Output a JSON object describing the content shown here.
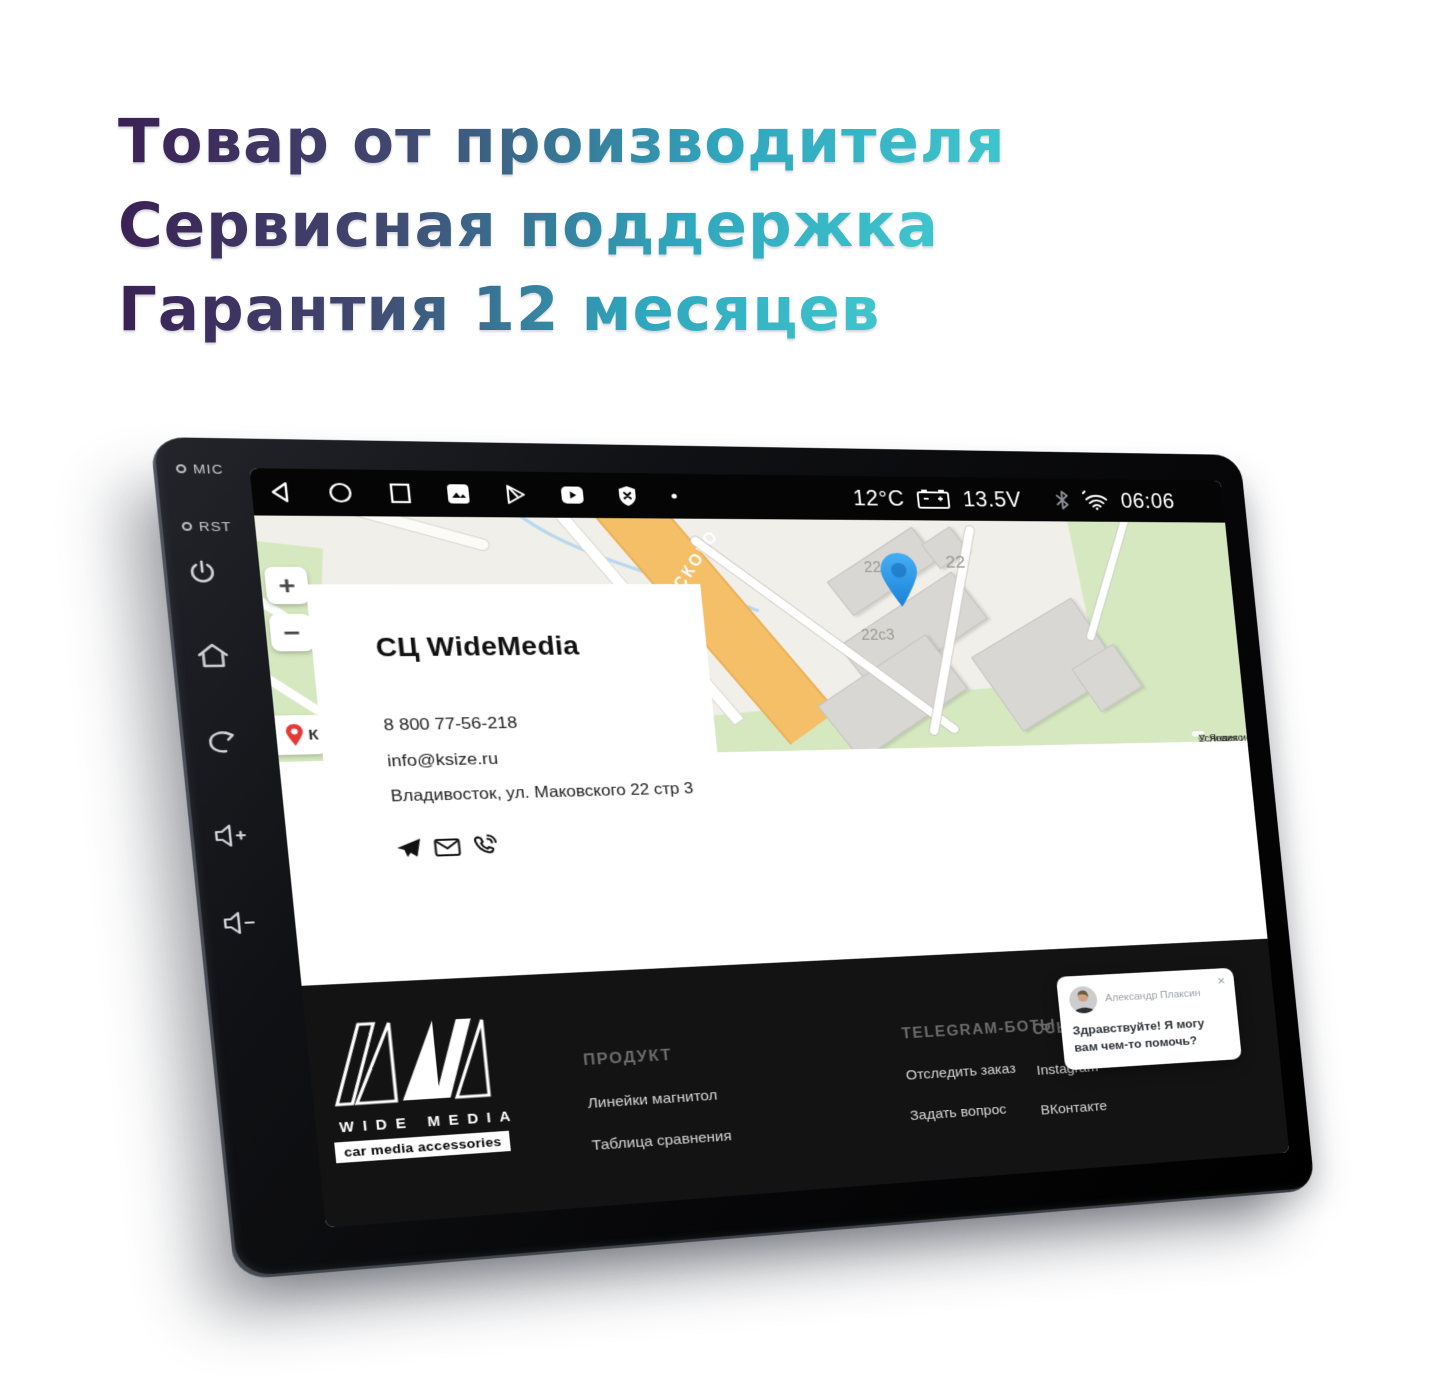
{
  "heading": {
    "line1": "Товар от производителя",
    "line2": "Сервисная поддержка",
    "line3": "Гарантия 12 месяцев"
  },
  "device": {
    "side": {
      "mic": "MIC",
      "rst": "RST"
    }
  },
  "status_bar": {
    "temperature": "12°C",
    "voltage": "13.5V",
    "time": "06:06"
  },
  "map": {
    "zoom_in": "+",
    "zoom_out": "−",
    "placemark": "К",
    "street": "ОВСКОГО",
    "buildings": [
      "22с1",
      "22",
      "22с3"
    ],
    "attribution": {
      "copyright": "© Яндекс ",
      "terms_link": "Условия использования"
    }
  },
  "contact": {
    "title": "СЦ WideMedia",
    "phone": "8 800 77-56-218",
    "email": "info@ksize.ru",
    "address": "Владивосток, ул. Маковского 22 стр 3"
  },
  "footer": {
    "brand": "WIDE MEDIA",
    "tagline": "car media accessories",
    "columns": [
      {
        "heading": "ПРОДУКТ",
        "links": [
          "Линейки магнитол",
          "Таблица сравнения"
        ]
      },
      {
        "heading": "TELEGRAM-БОТЫ",
        "links": [
          "Отследить заказ",
          "Задать вопрос"
        ]
      },
      {
        "heading": "ССЫЛКИ",
        "links": [
          "Instagram",
          "ВКонтакте"
        ]
      }
    ]
  },
  "chat": {
    "name": "Александр Плаксин",
    "message": "Здравствуйте! Я могу вам чем-то помочь?",
    "close": "×"
  },
  "colors": {
    "accent_purple": "#3b2155",
    "accent_teal": "#2fb9c2",
    "map_road_orange": "#f5bf68",
    "map_green": "#d6e8c0",
    "pin_blue": "#2f9ce8",
    "pin_red": "#e53935"
  }
}
